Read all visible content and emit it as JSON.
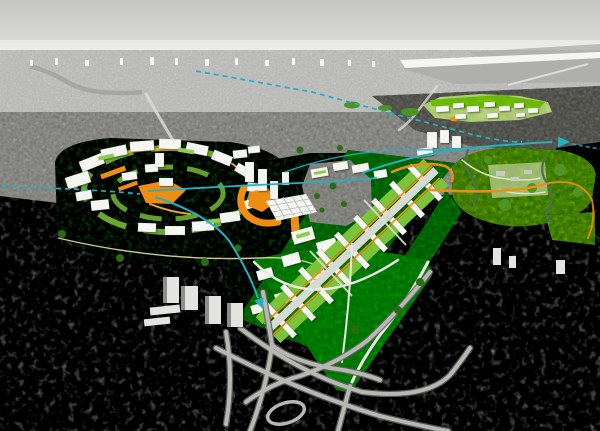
{
  "palette": {
    "sky_top": "#c6c6c4",
    "sky_horizon": "#f1f1ef",
    "haze": "#f5f5f3",
    "water": "#afafad",
    "bridge": "#dcdcda",
    "river_distant": "#a3a3a1",
    "distant_city": "#c9c9c7",
    "distant_towers": "#fbfbf9",
    "mid_city": "#a6a6a2",
    "mid_dark": "#7a7a76",
    "dark_city": "#32322f",
    "dark_edge": "#4a4a46",
    "road_light": "#b7b7b3",
    "plan_road": "#d8dbd4",
    "plan_white": "#f5f6f2",
    "plan_side": "#c3c8c1",
    "grid_line": "#b4bab2",
    "bw_tower": "#e3e3e1",
    "bw_tower_side": "#8d8d8b",
    "green_dark": "#2d6a15",
    "green_base": "#4f9422",
    "green_wedge": "#45a318",
    "lawn": "#7cc437",
    "lawn_pale": "#b8d584",
    "park_mid": "#7fa858",
    "park_pale": "#a8c47e",
    "park_path": "#dde4c8",
    "stream": "#4d7150",
    "orange": "#ef8c12",
    "orange_soft": "#f6a430",
    "cream": "#ead9a4",
    "cyan": "#23b0c1",
    "gray_patch": "#a2a29e",
    "park_bldg": "#cacac5",
    "roof_green": "#8ccf4e",
    "white_route": "#e8e8e4"
  }
}
